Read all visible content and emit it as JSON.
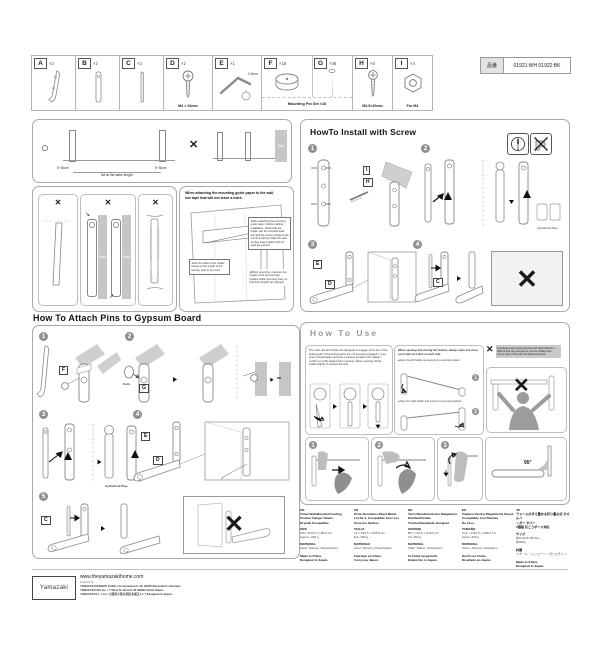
{
  "product_code": {
    "label": "品番",
    "value": "01921:WH 01922:BK"
  },
  "parts_row": {
    "pin_set_caption": "Mounting Pin Set ×16",
    "items": [
      {
        "id": "A",
        "qty": "×2",
        "caption": ""
      },
      {
        "id": "B",
        "qty": "×2",
        "caption": ""
      },
      {
        "id": "C",
        "qty": "×2",
        "caption": ""
      },
      {
        "id": "D",
        "qty": "×2",
        "caption": "M4 × 16mm"
      },
      {
        "id": "E",
        "qty": "×1",
        "caption": "",
        "note": "2.5mm"
      },
      {
        "id": "F",
        "qty": "×16",
        "caption": ""
      },
      {
        "id": "G",
        "qty": "×48",
        "caption": ""
      },
      {
        "id": "H",
        "qty": "×8",
        "caption": "M3.5×20mm"
      },
      {
        "id": "I",
        "qty": "×4",
        "caption": "For M4"
      }
    ]
  },
  "spacing_box": {
    "ok": "○",
    "ng": "✕",
    "dim_left": "5~30cm",
    "dim_right": "5~30cm",
    "center_note": "Set at the same length.",
    "wall": "Wall"
  },
  "ng_panels": {
    "x1": "✕",
    "x2": "✕",
    "x3": "✕",
    "wall_left": "Wall",
    "wall_right": "Wall"
  },
  "guide_note": {
    "heading1": "When attaching the mounting guide paper to the wall,",
    "heading2": "use tape that will not leave a mark.",
    "bullet_left": "●Set the width of the holder based on the length of the laundry pole to be used.",
    "bullet_right": "●After attaching the mounting guide paper, before starting installation, check that the holder can be mounted level and that the screw positions will not hit anything inside the wall, so they keep holders will not spoil the ground.",
    "bullet_right2": "●When mounting, measure the height of the left and right holders while mounting them so that their heights are aligned."
  },
  "install_screw": {
    "title": "HowTo Install with Screw",
    "step1": "1",
    "step2": "2",
    "step3": "3",
    "step4": "4",
    "label_i": "I",
    "label_h": "H",
    "label_e": "E",
    "label_d": "D",
    "label_c": "C",
    "cylindrical": "Cylindrical Pipe",
    "ng": "✕"
  },
  "attach_pins": {
    "title": "How To Attach Pins to Gypsum Board",
    "step1": "1",
    "step2": "2",
    "step3": "3",
    "step4": "4",
    "step5": "5",
    "label_f": "F",
    "label_g": "G",
    "label_e": "E",
    "label_d": "D",
    "label_c": "C",
    "coin": "Coin",
    "wall_a": "Wall",
    "wall_b": "Wall",
    "cylindrical": "Cylindrical Pipe",
    "ng": "✕"
  },
  "how_to_use": {
    "title": "How To Use",
    "intro": "The main unit and holder are designed to engage at the top of the locking part. If the locking parts are not securely engaged, it may open unexpectedly and pose a serious accident risk. Always confirm it is fully locked when opening. When opening, lift the holder slightly to release the lock.",
    "open_head": "When opening and closing the holders, always open and close one holder at a time on each side.",
    "open_left": "●Open the left holder and ensure it is securely locked.",
    "open_right": "●Open the right holder and ensure it is securely locked.",
    "s1": "1",
    "s2": "2",
    "warn_x": "✕",
    "warn": "Simultaneously locking the left and right holders is difficult and very dangerous, as the holders can spring open if they are not locked securely.",
    "big_x": "✕",
    "towel1": "1",
    "towel2": "2",
    "towel3": "3",
    "angle": "95°"
  },
  "languages": [
    {
      "lang": "EN",
      "name1": "Towel Wall-Mounted Folding",
      "name2": "Clothes Hanger Smart,",
      "name3": "Drywall Compatible",
      "size_label": "SIZE",
      "size1": "W9 × D10.5 × H35.5 cm",
      "size2": "Approx. 650 g",
      "material_label": "MATERIAL",
      "material": "Steel, Silicone, Polyethylene",
      "origin1": "Made in China.",
      "origin2": "Designed in Japan."
    },
    {
      "lang": "FR",
      "name1": "Porte-Serviettes Pliant Mural",
      "name2": "Lot De 2, Compatible Avec Les",
      "name3": "Cloisons Sèches",
      "size_label": "TAILLE",
      "size1": "L9 × P10,5 × H35,5 cm",
      "size2": "Env. 650 g",
      "material_label": "MATÉRIAU",
      "material": "Acier, Silicone, Polyéthylène",
      "origin1": "Fabriqué en Chine.",
      "origin2": "Conçu au Japon."
    },
    {
      "lang": "DE",
      "name1": "Turm Wandmontierter Klappbarer",
      "name2": "Handtuchhalter,",
      "name3": "Trockenbauwände Geeignet",
      "size_label": "GRÖSSE",
      "size1": "B9 × T10,5 × H35,5 cm",
      "size2": "Ca. 650 g",
      "material_label": "MATERIAL",
      "material": "Stahl, Silikon, Polyethylen",
      "origin1": "In China hergestellt.",
      "origin2": "Entworfen in Japan."
    },
    {
      "lang": "ES",
      "name1": "Toallero Percha Plegable De Pared,",
      "name2": "Compatible Con Paneles",
      "name3": "De Yeso",
      "size_label": "TAMAÑO",
      "size1": "An9 × Pr10,5 × Al35,5 cm",
      "size2": "Aprox. 650 g",
      "material_label": "MATERIAL",
      "material": "Acero, Silicona, Polietileno",
      "origin1": "Hecho en China.",
      "origin2": "Diseñado en Japón."
    },
    {
      "lang": "JP",
      "name1": "ウォール片手で畳める折り畳み式 タオルハ",
      "name2": "ンガー タワー",
      "name3": "2個組 石こうボード対応",
      "size_label": "サイズ",
      "size1": "約9×10.5×35.5cm",
      "size2": "約650g",
      "material_label": "材質",
      "material": "スチール・シリコーン・ポリエチレン",
      "origin1": "Made in China.",
      "origin2": "Designed in Japan."
    }
  ],
  "footer": {
    "logo": "Yamazaki",
    "url": "www.theyamazakihome.com",
    "imported_by": "Imported by",
    "line1": "YAMAZAKI EUROPE GmbH / Fennemannstr. 33, 40233 Düsseldorf, Germany",
    "line2": "YAMAZAKI USA Inc. / 7 West St. Bristol, RI 02809 United States",
    "line3": "YAMAZAKI Co., Ltd. / 大阪府大阪市西区北堀江2-1-7  Designed in Japan."
  }
}
